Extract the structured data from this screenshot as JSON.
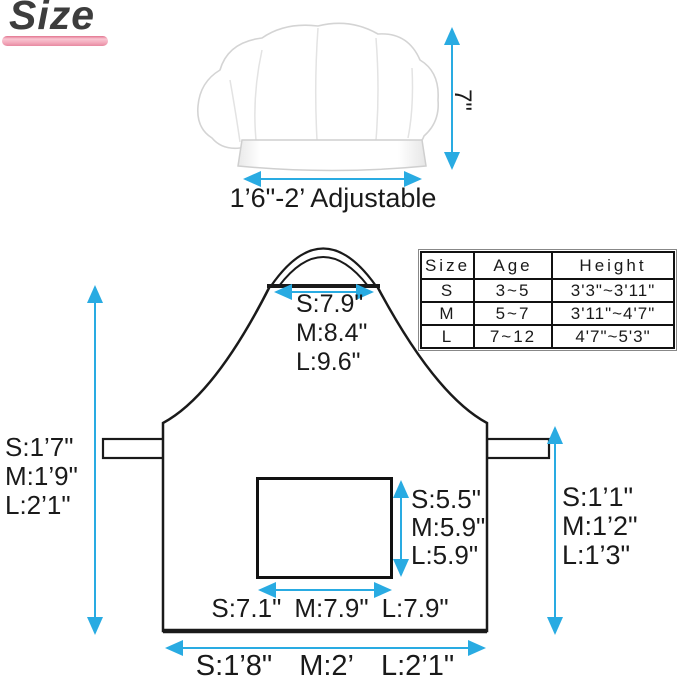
{
  "title": {
    "text": "Size"
  },
  "hat": {
    "height_label": "7\"",
    "width_label": "1’6\"-2’ Adjustable"
  },
  "size_table": {
    "headers": [
      "Size",
      "Age",
      "Height"
    ],
    "rows": [
      {
        "size": "S",
        "age": "3~5",
        "height": "3'3\"~3'11\""
      },
      {
        "size": "M",
        "age": "5~7",
        "height": "3'11\"~4'7\""
      },
      {
        "size": "L",
        "age": "7~12",
        "height": "4'7\"~5'3\""
      }
    ]
  },
  "apron": {
    "bib_width": {
      "s": "S:7.9\"",
      "m": "M:8.4\"",
      "l": "L:9.6\""
    },
    "left_length": {
      "s": "S:1’7\"",
      "m": "M:1’9\"",
      "l": "L:2’1\""
    },
    "right_length": {
      "s": "S:1’1\"",
      "m": "M:1’2\"",
      "l": "L:1’3\""
    },
    "pocket_height": {
      "s": "S:5.5\"",
      "m": "M:5.9\"",
      "l": "L:5.9\""
    },
    "pocket_width": {
      "s": "S:7.1\"",
      "m": "M:7.9\"",
      "l": "L:7.9\""
    },
    "bottom_width": {
      "s": "S:1’8\"",
      "m": "M:2’",
      "l": "L:2’1\""
    }
  },
  "colors": {
    "arrow_blue": "#29abe2",
    "outline_black": "#1a1a1a",
    "accent_pink": "#f3abbd"
  }
}
